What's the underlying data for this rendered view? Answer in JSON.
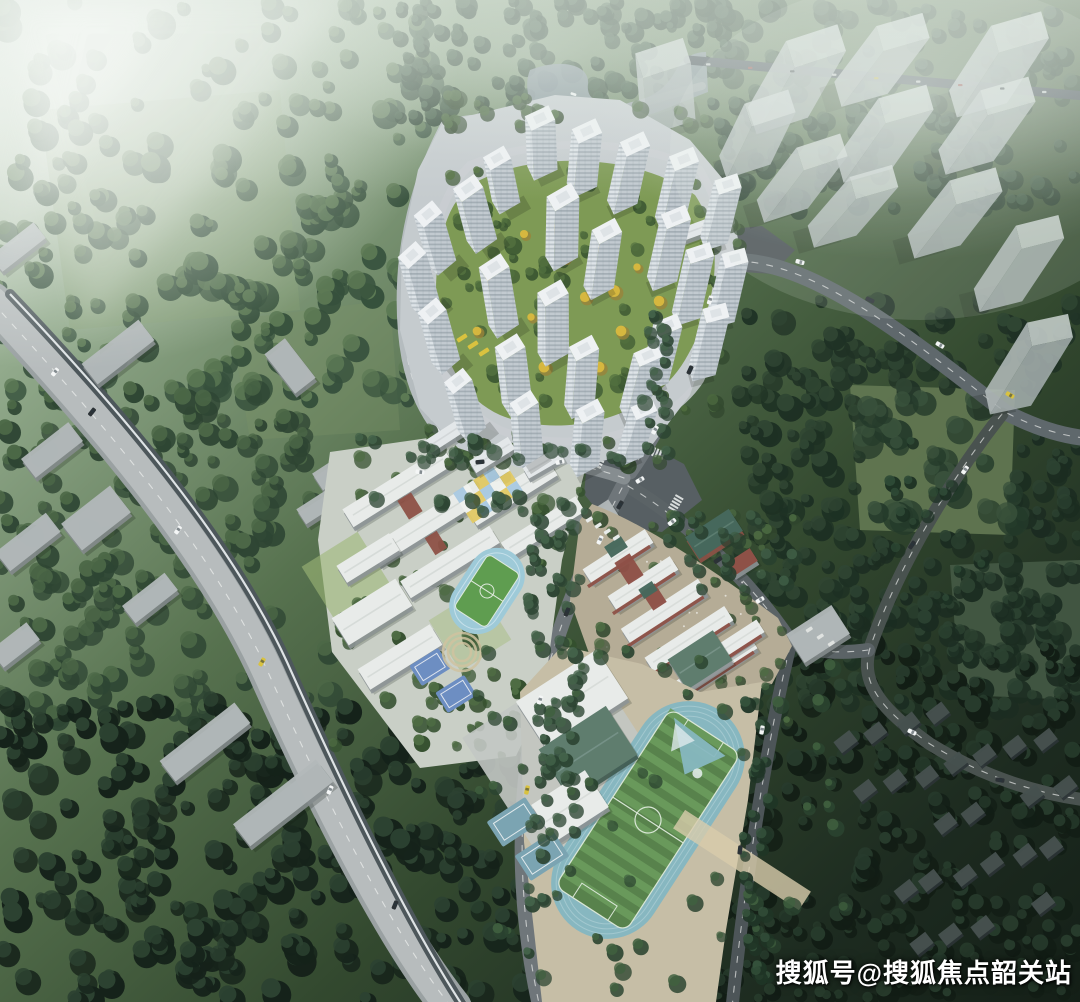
{
  "watermark": {
    "text": "搜狐号@搜狐焦点韶关站",
    "color": "#ffffff"
  },
  "scene": {
    "type": "aerial-masterplan-rendering",
    "description": "Bird's-eye rendering of a residential development: white high-rise tower cluster with landscaped courtyard, school campus with small running track, middle school, sports complex with stadium track and gymnasium, surrounded by misty forest, a highway with rail line, ghost massing blocks and village houses",
    "regions": [
      "misty-forest-hills",
      "lake-with-boats",
      "residential-tower-cluster",
      "central-courtyard-gardens",
      "kindergarten-checker-roof",
      "school-campus",
      "small-running-track",
      "basketball-courts",
      "middle-school-red-brick",
      "gymnasium-green-roof",
      "stadium-running-track",
      "highway-with-rail-line",
      "ghost-massing-buildings",
      "village-houses",
      "road-network",
      "watermark"
    ]
  },
  "palette": {
    "wm": "#ffffff",
    "mist": "#f2f6f1",
    "fLight": "#5d7a55",
    "fMid": "#3c5540",
    "fDark": "#2a3e2e",
    "fDeep": "#16231a",
    "meadow": "#647953",
    "meadowBright": "#87a076",
    "roadLight": "#b7bcbd",
    "roadMid": "#6f767a",
    "roadDark": "#49524f",
    "railDark": "#4d575b",
    "railLine": "#eef3f4",
    "plazaAsphalt": "#575f63",
    "plazaDark": "#4e5659",
    "towerRoof": "#eef1f3",
    "towerLit": "#dde3e7",
    "towerMid": "#c2cad0",
    "towerShade": "#9fa9b2",
    "ghostTop": "#ccd4d2",
    "ghostLit": "#b6bfbf",
    "ghostShade": "#95a0a1",
    "slabGray": "#b2b8b9",
    "villageRoof": "#47514f",
    "campusRoof": "#e8ebe9",
    "brick": "#8e5147",
    "greenRoof": "#5f7d6e",
    "greenRoofDark": "#46685c",
    "plazaTan": "#cfc2a3",
    "plazaTanGray": "#b5ac96",
    "trackBlue": "#9ecad8",
    "trackTeal": "#87b7c0",
    "fieldGreen": "#58824c",
    "fieldStripe": "#6b9b5d",
    "courtBlue": "#6d8ec2",
    "courtTeal": "#7ba4b2",
    "checkBlue": "#a9c9e2",
    "checkYellow": "#e2c964",
    "lawn": "#7e9a55",
    "treeYellow": "#d9b93f",
    "treeGreen": "#47653f",
    "water": "#85939b",
    "carWhite": "#f4f6f6",
    "carDark": "#2c3236",
    "carYellow": "#d9c23f",
    "carRed": "#a33c35"
  }
}
